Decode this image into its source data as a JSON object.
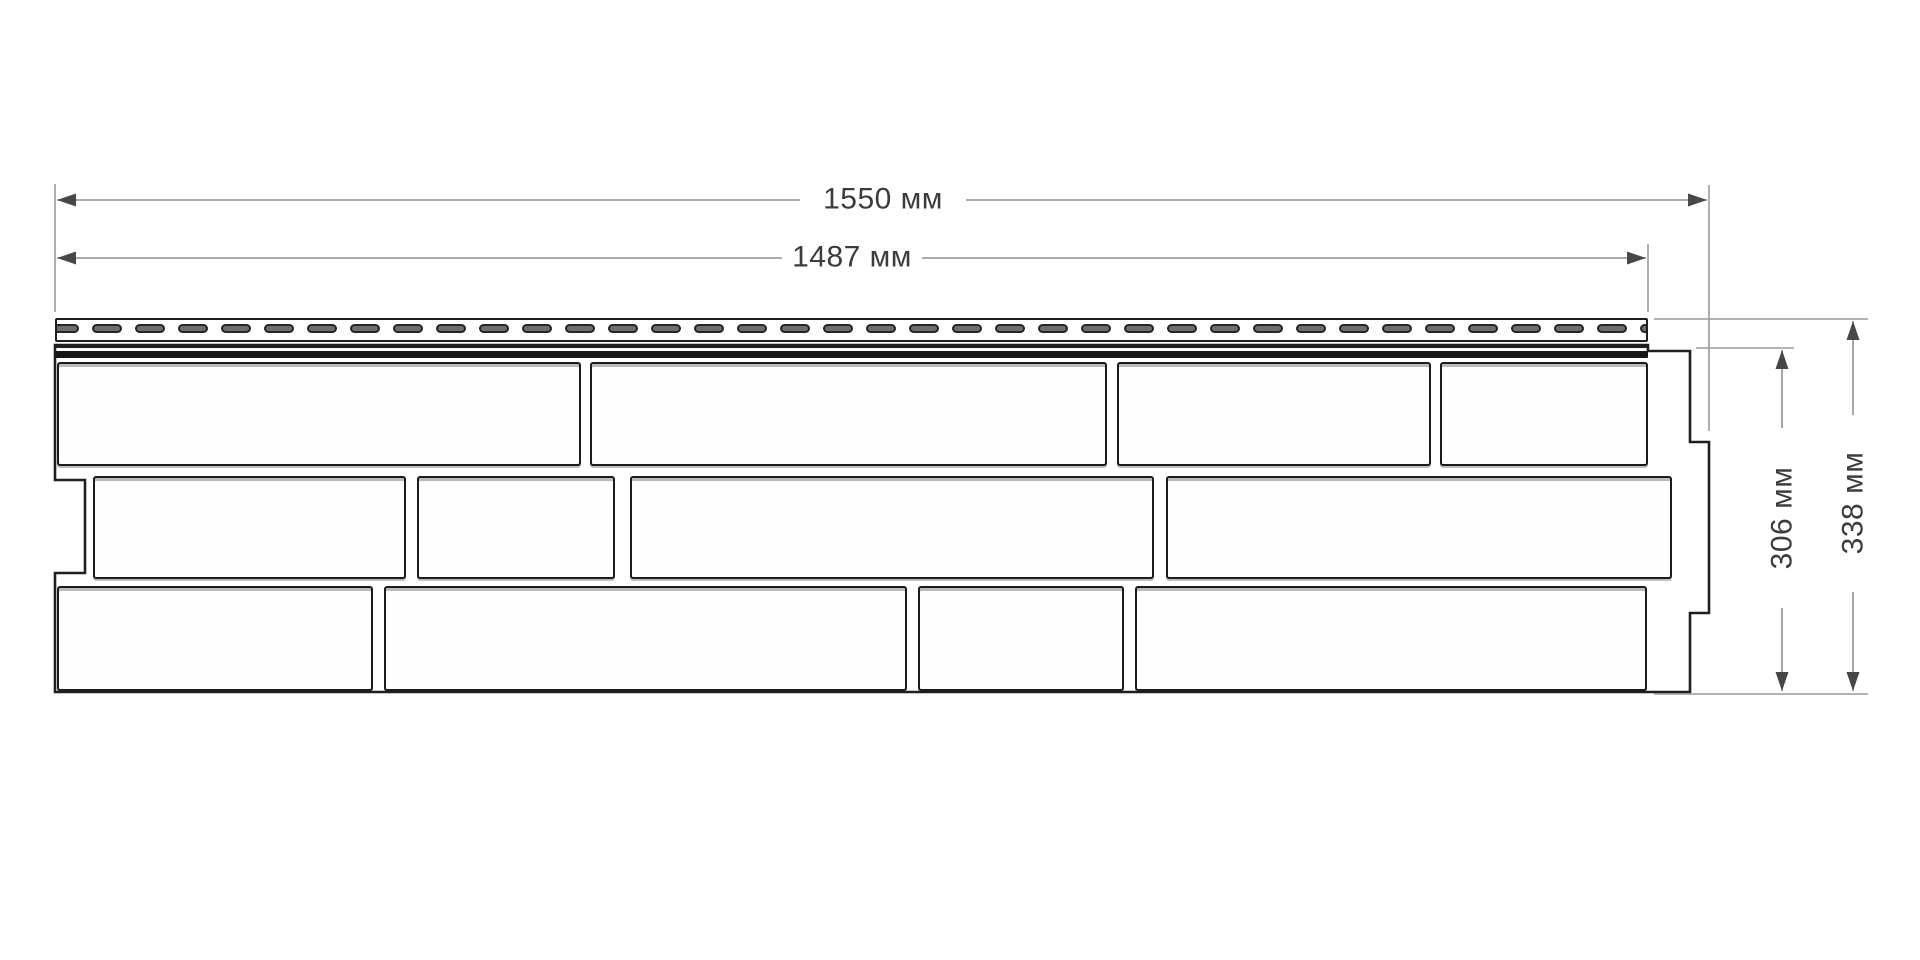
{
  "diagram": {
    "description": "Technical dimension drawing of a facade siding panel with brick pattern and perforated nailing strip",
    "unit": "мм",
    "labels": {
      "total_width": "1550 мм",
      "working_width": "1487 мм",
      "panel_height": "306 мм",
      "total_height": "338 мм"
    },
    "values": {
      "total_width_mm": 1550,
      "working_width_mm": 1487,
      "panel_height_mm": 306,
      "total_height_mm": 338
    },
    "colors": {
      "background": "#ffffff",
      "outline": "#1f1f1f",
      "dimension_line": "#8f8f8f",
      "extension_line": "#9a9a9a",
      "arrow": "#474747",
      "slot_fill": "#6d6d6d",
      "text": "#3c3c3c"
    },
    "panel": {
      "outline_points": "55,345 1648,345 1648,351 1690,351 1690,442 1709,442 1709,613 1690,613 1690,692 55,692 55,573 85,573 85,480 55,480",
      "nail_strip": {
        "x": 55,
        "y": 318,
        "width": 1593,
        "height": 24,
        "slot_count": 39,
        "slot_width": 30,
        "slot_height": 9,
        "slot_pitch": 43,
        "slot_top": 4,
        "slot_start": -8
      },
      "lock_line": {
        "x": 55,
        "y": 346,
        "width": 1593,
        "height": 2
      },
      "lock_band": {
        "x": 55,
        "y": 351,
        "width": 1593,
        "height": 7
      },
      "rows": [
        {
          "top": 362,
          "height": 104,
          "bricks": [
            {
              "left": 57,
              "width": 524
            },
            {
              "left": 590,
              "width": 517
            },
            {
              "left": 1117,
              "width": 314
            },
            {
              "left": 1440,
              "width": 208
            }
          ]
        },
        {
          "top": 476,
          "height": 103,
          "bricks": [
            {
              "left": 93,
              "width": 313
            },
            {
              "left": 417,
              "width": 198
            },
            {
              "left": 630,
              "width": 524
            },
            {
              "left": 1166,
              "width": 506
            }
          ]
        },
        {
          "top": 586,
          "height": 105,
          "bricks": [
            {
              "left": 57,
              "width": 316
            },
            {
              "left": 384,
              "width": 523
            },
            {
              "left": 918,
              "width": 206
            },
            {
              "left": 1135,
              "width": 512
            }
          ]
        }
      ]
    }
  }
}
